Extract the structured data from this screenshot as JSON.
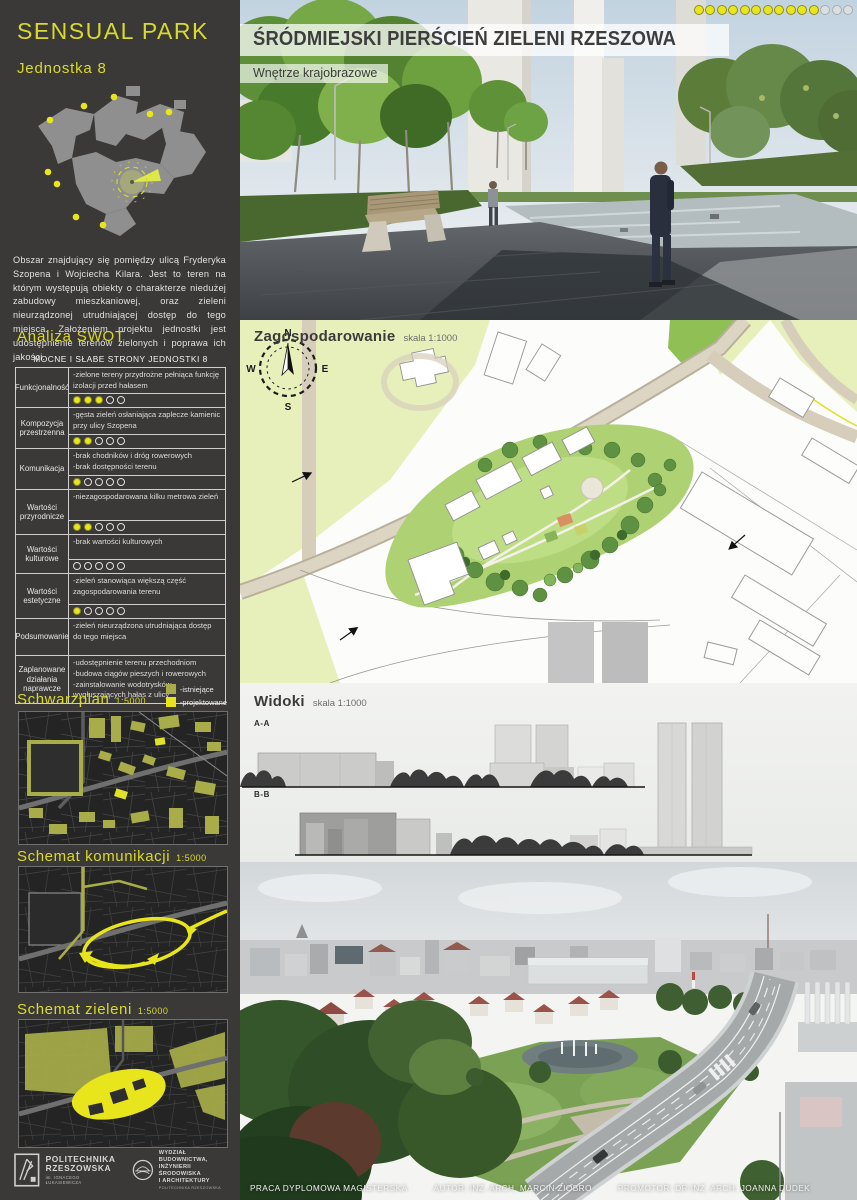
{
  "colors": {
    "accent_yellow": "#d9da2b",
    "bright_yellow": "#e8e51c",
    "olive_existing": "#a9ad49",
    "sidebar_bg": "#3b3938"
  },
  "sidebar": {
    "title": "SENSUAL PARK",
    "subtitle": "Jednostka 8",
    "description": "Obszar znajdujący się pomiędzy ulicą Fryderyka Szopena i Wojciecha Kilara. Jest to teren na którym występują obiekty o charakterze niedużej zabudowy mieszkaniowej, oraz zieleni nieurządzonej utrudniającej dostęp do tego miejsca. Założeniem projektu jednostki jest udostępnienie terenów zielonych i poprawa ich jakości.",
    "swot": {
      "heading": "Analiza SWOT",
      "table_title": "MOCNE I SŁABE STRONY JEDNOSTKI 8",
      "rating_max": 5,
      "rows": [
        {
          "label": "Funkcjonalność",
          "text": "-zielone tereny przydrożne pełniąca funkcję izolacji przed hałasem",
          "rating": 3
        },
        {
          "label": "Kompozycja przestrzenna",
          "text": "-gęsta zieleń osłaniająca zaplecze kamienic przy ulicy Szopena",
          "rating": 2
        },
        {
          "label": "Komunikacja",
          "text": "-brak chodników i dróg rowerowych\n-brak dostępności terenu",
          "rating": 1
        },
        {
          "label": "Wartości przyrodnicze",
          "text": "-niezagospodarowana kilku metrowa zieleń",
          "rating": 2
        },
        {
          "label": "Wartości kulturowe",
          "text": "-brak wartości  kulturowych",
          "rating": 0
        },
        {
          "label": "Wartości estetyczne",
          "text": "-zieleń stanowiąca większą część zagospodarowania terenu",
          "rating": 1
        },
        {
          "label": "Podsumowanie",
          "text": "-zieleń nieurządzona utrudniająca dostęp do tego miejsca",
          "rating": null
        },
        {
          "label": "Zaplanowane działania naprawcze",
          "text": "-udostępnienie terenu przechodniom\n-budowa ciągów pieszych i rowerowych\n-zainstalowanie wodotrysków wygłuszających hałas z ulicy",
          "rating": null
        }
      ]
    },
    "legend": [
      {
        "label": "-istniejące",
        "color": "#a9ad49"
      },
      {
        "label": "-projektowane",
        "color": "#e8e51c"
      }
    ],
    "maps": [
      {
        "title": "Schwarzplan",
        "scale": "1:5000"
      },
      {
        "title": "Schemat komunikacji",
        "scale": "1:5000"
      },
      {
        "title": "Schemat zieleni",
        "scale": "1:5000"
      }
    ],
    "logos": {
      "university_name": "POLITECHNIKA\nRZESZOWSKA",
      "university_sub": "im. IGNACEGO ŁUKASIEWICZA",
      "faculty_name": "WYDZIAŁ\nBUDOWNICTWA,\nINŻYNIERII ŚRODOWISKA\nI ARCHITEKTURY",
      "faculty_sub": "POLITECHNIKA RZESZOWSKA"
    }
  },
  "main": {
    "title": "ŚRÓDMIEJSKI PIERŚCIEŃ ZIELENI RZESZOWA",
    "subtitle": "Wnętrze krajobrazowe",
    "progress_dots": {
      "filled": 11,
      "total": 14
    },
    "plan": {
      "title": "Zagospodarowanie",
      "scale_label": "skala 1:1000",
      "compass": {
        "n": "N",
        "e": "E",
        "s": "S",
        "w": "W"
      }
    },
    "views": {
      "title": "Widoki",
      "scale_label": "skala 1:1000",
      "section_a": "A-A",
      "section_b": "B-B"
    },
    "footer": {
      "work_type": "PRACA DYPLOMOWA MAGISTERSKA",
      "author": "AUTOR: INŻ. ARCH. MARCIN ZIOBRO",
      "promoter": "PROMOTOR: DR INŻ. ARCH. JOANNA DUDEK"
    }
  }
}
